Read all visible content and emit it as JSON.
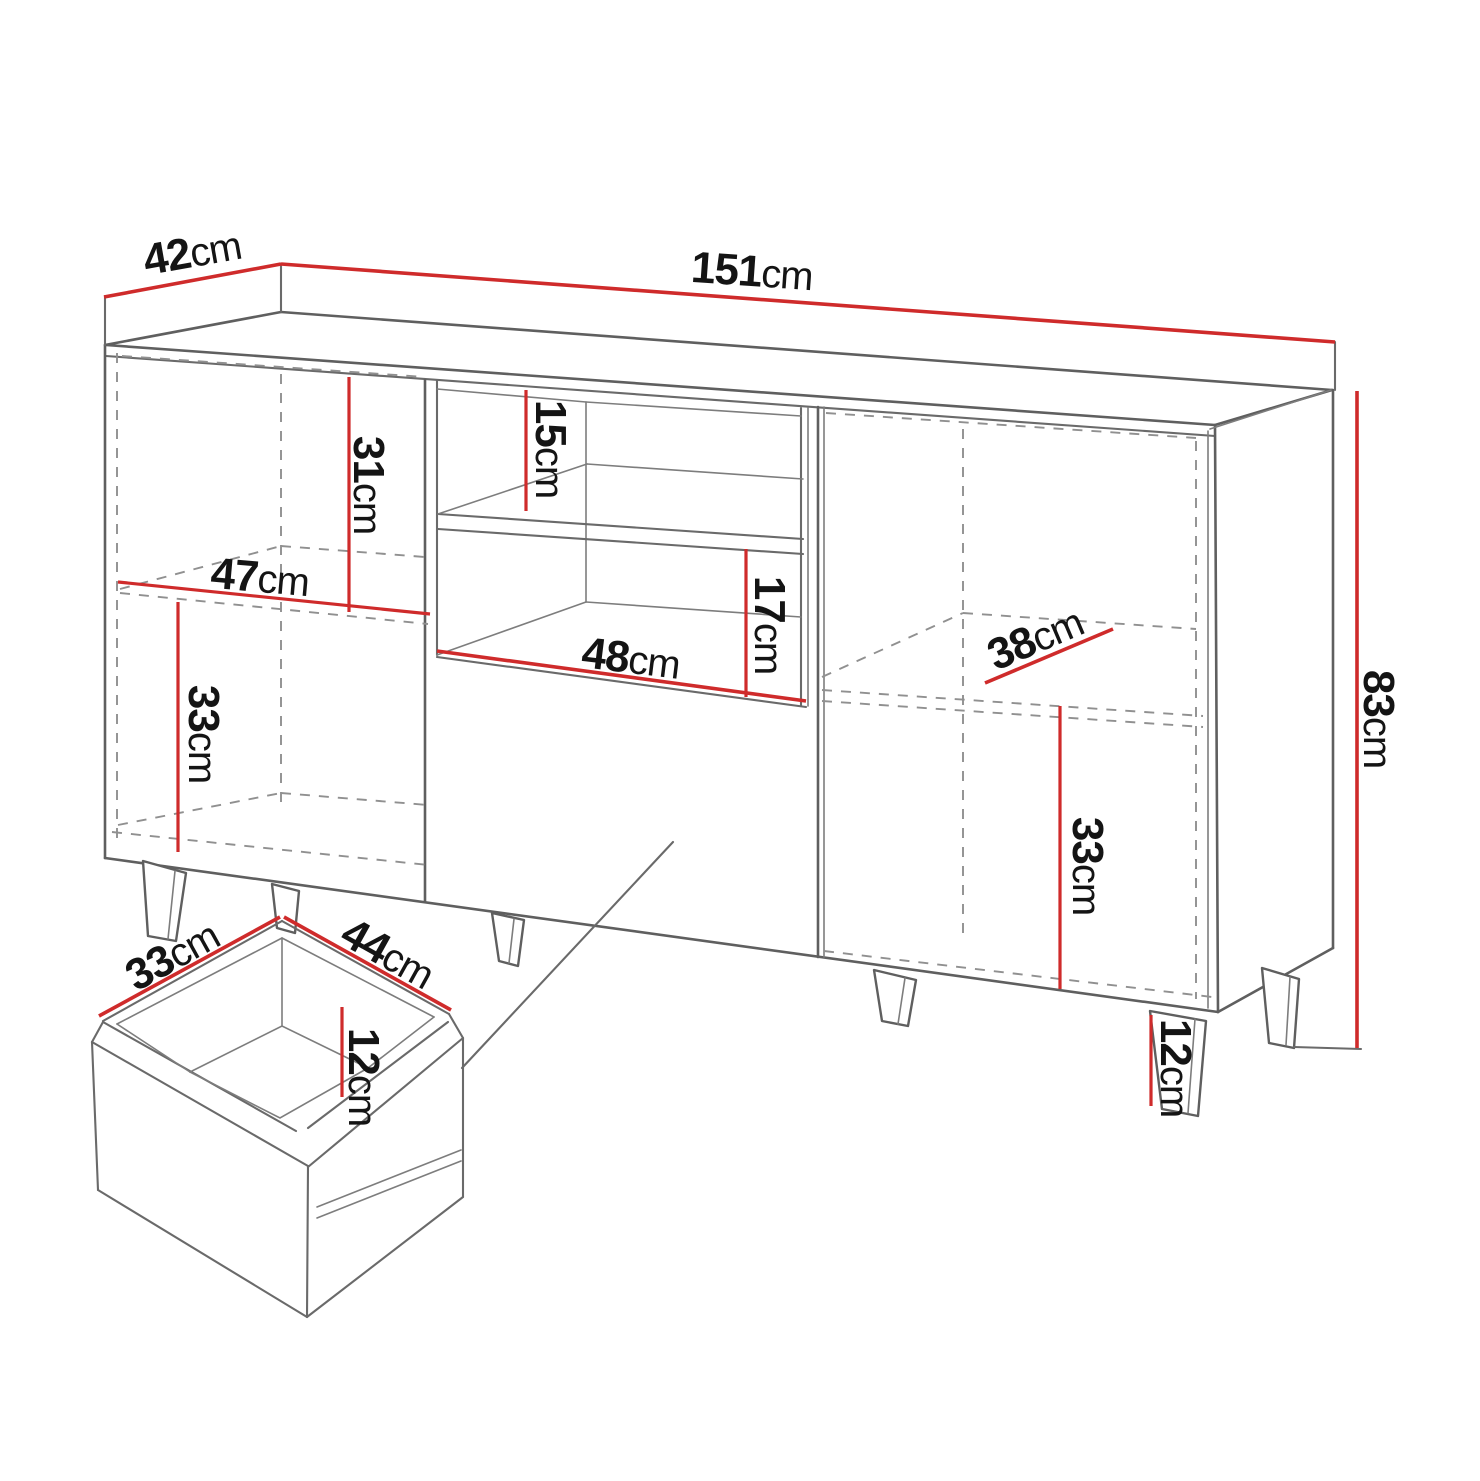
{
  "diagram": {
    "kind": "furniture-technical-drawing",
    "subject": "sideboard-with-drawer-detail",
    "colors": {
      "dimension_line": "#cf2b2b",
      "outline": "#5f5f5f",
      "hidden_line": "#909090",
      "text": "#141414",
      "background": "#ffffff"
    },
    "cabinet": {
      "width": {
        "value": "151",
        "unit": "cm"
      },
      "depth": {
        "value": "42",
        "unit": "cm"
      },
      "height": {
        "value": "83",
        "unit": "cm"
      },
      "left_section_upper_height": {
        "value": "31",
        "unit": "cm"
      },
      "left_section_width": {
        "value": "47",
        "unit": "cm"
      },
      "left_section_lower_height": {
        "value": "33",
        "unit": "cm"
      },
      "niche_upper_height": {
        "value": "15",
        "unit": "cm"
      },
      "niche_lower_height": {
        "value": "17",
        "unit": "cm"
      },
      "niche_width": {
        "value": "48",
        "unit": "cm"
      },
      "right_section_depth": {
        "value": "38",
        "unit": "cm"
      },
      "right_section_lower_height": {
        "value": "33",
        "unit": "cm"
      },
      "leg_height": {
        "value": "12",
        "unit": "cm"
      }
    },
    "drawer": {
      "depth": {
        "value": "33",
        "unit": "cm"
      },
      "width": {
        "value": "44",
        "unit": "cm"
      },
      "height": {
        "value": "12",
        "unit": "cm"
      }
    }
  }
}
